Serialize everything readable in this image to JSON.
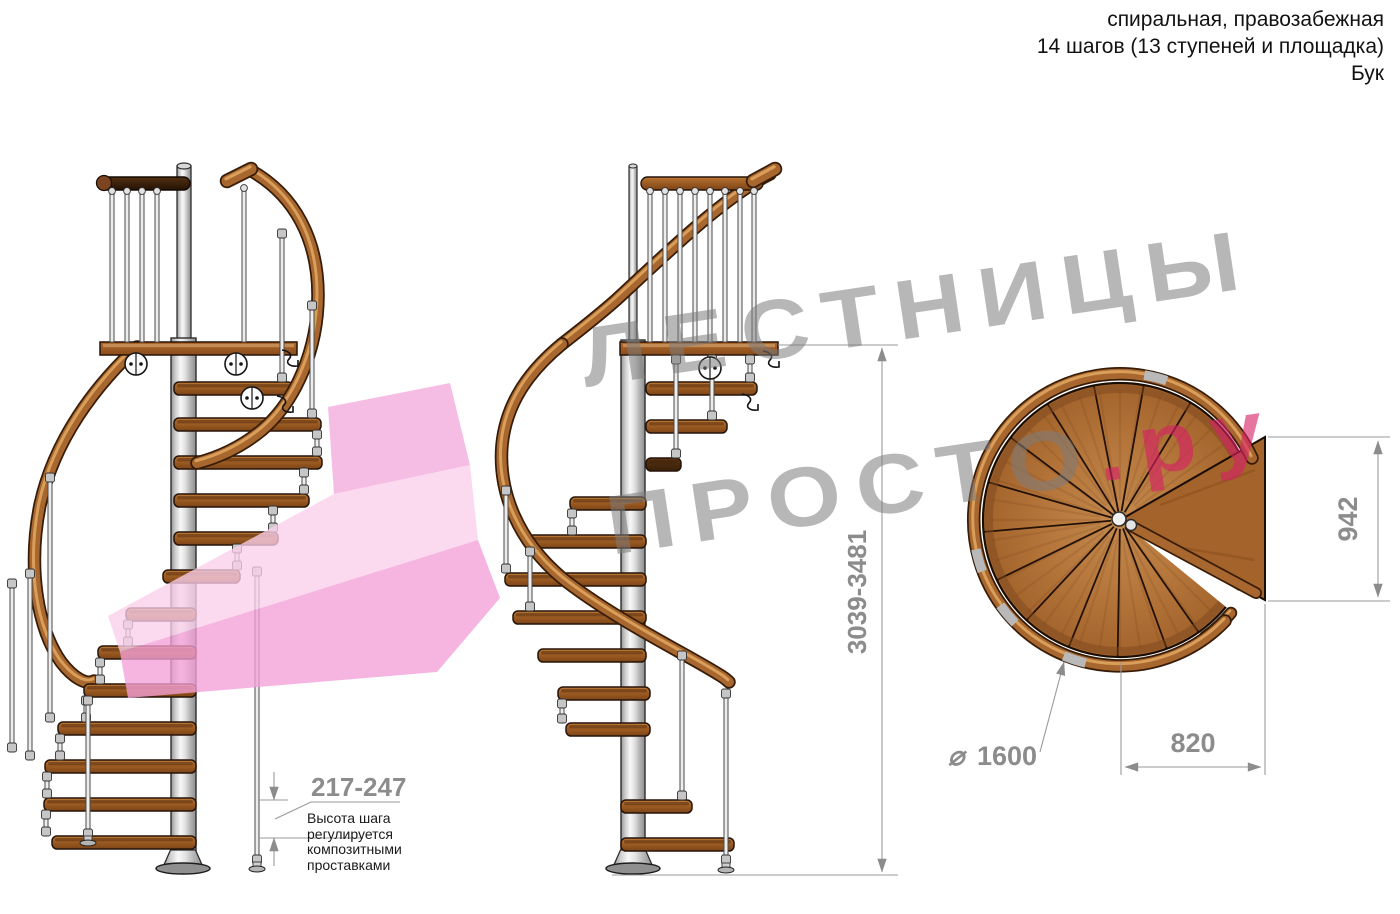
{
  "header": {
    "line1": "спиральная, правозабежная",
    "line2": "14 шагов (13 ступеней и площадка)",
    "line3": "Бук"
  },
  "watermark": {
    "line1": "ЛЕСТНИЦЫ",
    "line2_main": "ПРОСТО",
    "line2_accent": ".ру"
  },
  "dimensions": {
    "step_height": {
      "value": "217-247",
      "note_lines": [
        "Высота шага",
        "регулируется",
        "композитными",
        "проставками"
      ]
    },
    "total_height": {
      "value": "3039-3481"
    },
    "platform_width": {
      "value": "942"
    },
    "diameter": {
      "symbol": "⌀",
      "value": "1600"
    },
    "platform_depth": {
      "value": "820"
    }
  },
  "colors": {
    "accent_pink": "#e23b76",
    "arrow_pink": "#f3a7db",
    "watermark_gray": "#9c9c9c",
    "wood_brown": "#a2622c",
    "dark_rail": "#3d2410",
    "dimension_gray": "#8c8c8c",
    "metal_light": "#ededed"
  }
}
